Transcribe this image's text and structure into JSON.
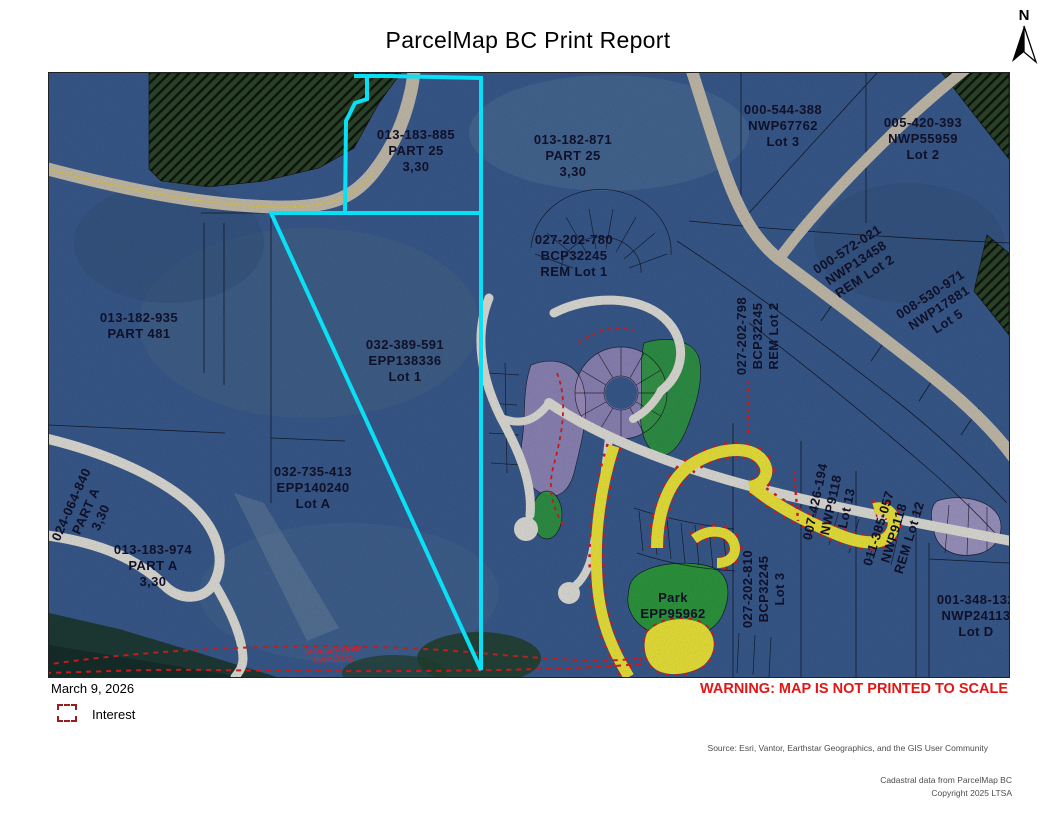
{
  "page": {
    "title": "ParcelMap BC Print Report",
    "north_label": "N",
    "date": "March 9, 2026",
    "warning": "WARNING: MAP IS NOT PRINTED TO SCALE",
    "source": "Source: Esri, Vantor, Earthstar Geographics, and the GIS User Community",
    "copyright": [
      "Cadastral data from ParcelMap BC",
      "Copyright 2025 LTSA"
    ]
  },
  "legend": {
    "items": [
      {
        "id": "interest",
        "label": "Interest",
        "swatch": "red-dashed-square",
        "color": "#9a1d1d"
      }
    ]
  },
  "map": {
    "colors": {
      "highlight_cyan": "#0ae0f5",
      "interest_red": "#dd2020",
      "park_green": "#2f9e41",
      "subdivision_purple": "#a995c9",
      "road_yellow": "#f5ee3d",
      "parcel_blue": "#3b5e93"
    },
    "labels": [
      {
        "id": "013-183-885",
        "lines": [
          "013-183-885",
          "PART 25",
          "3,30"
        ],
        "x": 367,
        "y": 78,
        "rot": 0
      },
      {
        "id": "013-182-871",
        "lines": [
          "013-182-871",
          "PART 25",
          "3,30"
        ],
        "x": 524,
        "y": 83,
        "rot": 0
      },
      {
        "id": "000-544-388",
        "lines": [
          "000-544-388",
          "NWP67762",
          "Lot 3"
        ],
        "x": 734,
        "y": 53,
        "rot": 0
      },
      {
        "id": "005-420-393",
        "lines": [
          "005-420-393",
          "NWP55959",
          "Lot 2"
        ],
        "x": 874,
        "y": 66,
        "rot": 0
      },
      {
        "id": "027-202-780",
        "lines": [
          "027-202-780",
          "BCP32245",
          "REM Lot 1"
        ],
        "x": 525,
        "y": 183,
        "rot": 0
      },
      {
        "id": "000-572-021",
        "lines": [
          "000-572-021",
          "NWP13458",
          "REM Lot 2"
        ],
        "x": 807,
        "y": 190,
        "rot": -33
      },
      {
        "id": "008-530-971",
        "lines": [
          "008-530-971",
          "NWP17881",
          "Lot 5"
        ],
        "x": 890,
        "y": 235,
        "rot": -33
      },
      {
        "id": "013-182-935",
        "lines": [
          "013-182-935",
          "PART 481"
        ],
        "x": 90,
        "y": 253,
        "rot": 0
      },
      {
        "id": "032-389-591",
        "lines": [
          "032-389-591",
          "EPP138336",
          "Lot 1"
        ],
        "x": 356,
        "y": 288,
        "rot": 0
      },
      {
        "id": "027-202-798",
        "lines": [
          "027-202-798",
          "BCP32245",
          "REM Lot 2"
        ],
        "x": 709,
        "y": 263,
        "rot": -90
      },
      {
        "id": "032-735-413",
        "lines": [
          "032-735-413",
          "EPP140240",
          "Lot A"
        ],
        "x": 264,
        "y": 415,
        "rot": 0
      },
      {
        "id": "024-064-840",
        "lines": [
          "024-064-840",
          "PART A",
          "3,30"
        ],
        "x": 37,
        "y": 438,
        "rot": -66
      },
      {
        "id": "013-183-974",
        "lines": [
          "013-183-974",
          "PART A",
          "3,30"
        ],
        "x": 104,
        "y": 493,
        "rot": 0
      },
      {
        "id": "007-426-194",
        "lines": [
          "007-426-194",
          "NWP9118",
          "Lot 13"
        ],
        "x": 782,
        "y": 432,
        "rot": -78
      },
      {
        "id": "011-385-057",
        "lines": [
          "011-385-057",
          "NWP9118",
          "REM Lot 12"
        ],
        "x": 845,
        "y": 460,
        "rot": -73
      },
      {
        "id": "027-202-810",
        "lines": [
          "027-202-810",
          "BCP32245",
          "Lot 3"
        ],
        "x": 715,
        "y": 516,
        "rot": -90
      },
      {
        "id": "park-epp95962",
        "lines": [
          "Park",
          "EPP95962"
        ],
        "x": 624,
        "y": 533,
        "rot": 0
      },
      {
        "id": "001-348-132",
        "lines": [
          "001-348-132",
          "NWP24113",
          "Lot D"
        ],
        "x": 927,
        "y": 543,
        "rot": 0
      },
      {
        "id": "statutory-row",
        "lines": [
          "Statutory ROW",
          "NWP13841"
        ],
        "x": 284,
        "y": 582,
        "rot": -3,
        "cls": "red"
      }
    ]
  }
}
